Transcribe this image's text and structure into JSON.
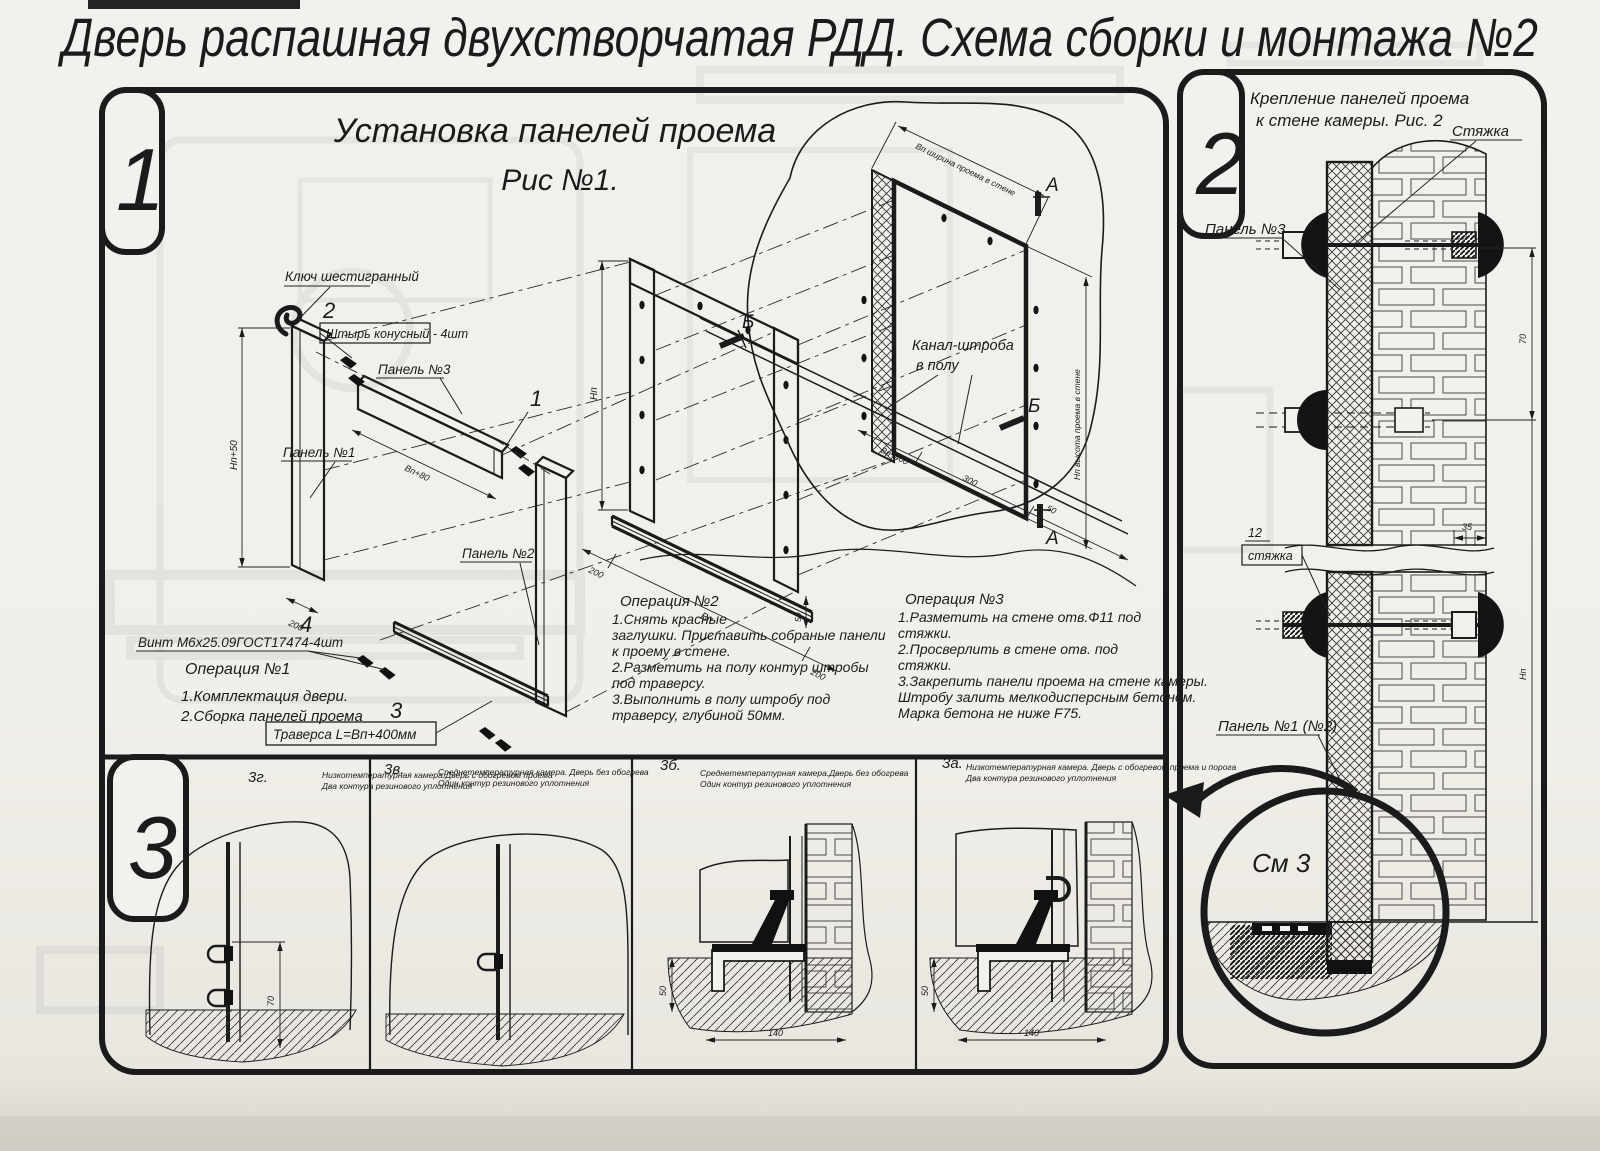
{
  "page": {
    "title": "Дверь распашная двухстворчатая РДД.  Схема сборки и монтажа №2"
  },
  "fig1": {
    "badge": "1",
    "title": "Установка панелей проема",
    "subtitle": "Рис №1.",
    "callouts": {
      "n1": "1",
      "n2": "2",
      "n3": "3",
      "n4": "4"
    },
    "labels": {
      "hex_key": "Ключ шестигранный",
      "pin": "Штырь конусный - 4шт",
      "panel3": "Панель №3",
      "panel1": "Панель №1",
      "panel2": "Панель №2",
      "screw": "Винт М6х25.09ГОСТ17474-4шт",
      "traverse": "Траверса  L=Bп+400мм",
      "channel_line1": "Канал-штроба",
      "channel_line2": "в полу"
    },
    "markers": {
      "a": "А",
      "b": "Б"
    },
    "dims": {
      "h_plus": "Нп+50",
      "w_plus": "Вп+80",
      "d200": "200",
      "d50": "50",
      "d300": "300",
      "w": "Вп",
      "h": "Нп",
      "w400": "Вп+400",
      "wall_w": "Вп ширина проема в стене",
      "wall_h": "Нп высота проема в стене"
    },
    "op1": {
      "title": "Операция №1",
      "lines": [
        "1.Комплектация двери.",
        "2.Сборка панелей проема"
      ]
    },
    "op2": {
      "title": "Операция №2",
      "lines": [
        "1.Снять красные",
        "заглушки. Приставить собраные панели",
        "к проему в стене.",
        "2.Разметить на полу контур штробы",
        "под траверсу.",
        "3.Выполнить в полу штробу под",
        "траверсу, глубиной 50мм."
      ]
    },
    "op3": {
      "title": "Операция №3",
      "lines": [
        "1.Разметить на стене отв.Ф11 под",
        "стяжки.",
        "2.Просверлить в стене отв.  под",
        "стяжки.",
        "3.Закрепить панели проема на стене камеры.",
        "Штробу залить мелкодисперсным бетоном.",
        "Марка бетона не ниже  F75."
      ]
    }
  },
  "fig2": {
    "badge": "2",
    "title_line1": "Крепление панелей проема",
    "title_line2": "к стене камеры. Рис. 2",
    "labels": {
      "tie_top": "Стяжка",
      "panel3": "Панель №3",
      "tie_no": "12",
      "tie_word": "стяжка",
      "panel12": "Панель №1 (№2)",
      "detail": "См 3"
    },
    "dims": {
      "d70": "70",
      "d35": "35",
      "h": "Нп"
    }
  },
  "fig3": {
    "badge": "3",
    "cells": [
      {
        "code": "3г.",
        "cap1": "Низкотемпературная камера.Дверь с обогревом проема",
        "cap2": "Два контура резинового уплотнения"
      },
      {
        "code": "3в.",
        "cap1": "Среднетемпературная камера. Дверь без обогрева",
        "cap2": "Один контур резинового уплотнения"
      },
      {
        "code": "3б.",
        "cap1": "Среднетемпературная камера.Дверь без обогрева",
        "cap2": "Один контур резинового уплотнения"
      },
      {
        "code": "3а.",
        "cap1": "Низкотемпературная камера. Дверь с обогревом проема и порога",
        "cap2": "Два контура резинового уплотнения"
      }
    ],
    "dims": {
      "d70": "70",
      "d50": "50",
      "d140": "140"
    }
  }
}
